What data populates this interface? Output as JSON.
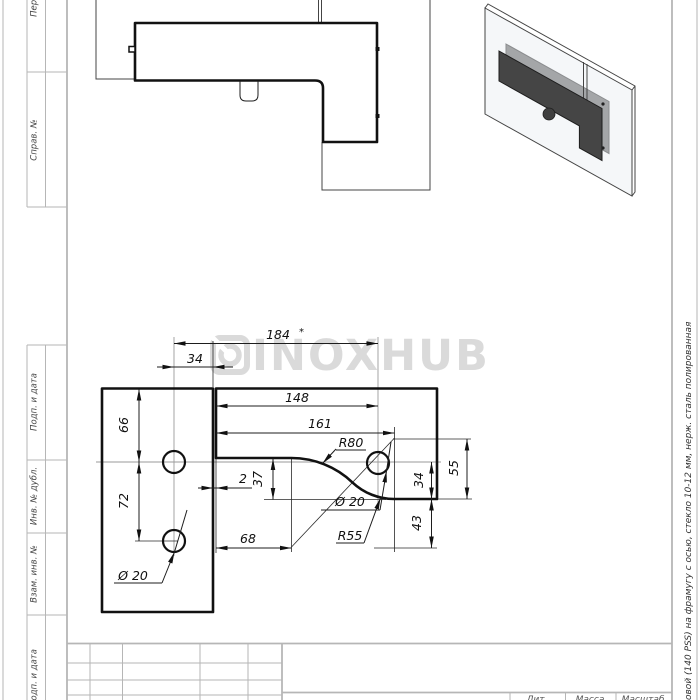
{
  "watermark": {
    "brand": "INOXHUB",
    "color": "#dadada"
  },
  "left_margin": {
    "boxes": [
      {
        "label": "Перв. примен."
      },
      {
        "label": "Справ. №"
      },
      {
        "label": "Подп. и дата"
      },
      {
        "label": "Инв. № дубл."
      },
      {
        "label": "Взам. инв. №"
      },
      {
        "label": "Подп. и дата"
      }
    ]
  },
  "right_margin": {
    "description": "овой (140 PSS)  на фрамугу с осью, стекло 10-12 мм, нерж. сталь полированная"
  },
  "title_block": {
    "lit": "Лит.",
    "mass": "Масса",
    "scale_label": "Масштаб"
  },
  "dimensions": {
    "overall_width": "184",
    "overall_star": "*",
    "hole_to_edge": "34",
    "gap": "2",
    "edge_to_hole": "148",
    "edge_to_r55_center": "161",
    "top_to_hole": "66",
    "hole_spacing": "72",
    "curve_drop": "37",
    "edge_to_r80_center": "68",
    "r55_center_height": "55",
    "hole_to_bottom": "34",
    "r80_center_below": "43",
    "radius_big": "R80",
    "radius_small": "R55",
    "hole_dia_left": "Ø 20",
    "hole_dia_right": "Ø 20"
  },
  "colors": {
    "drawing_line": "#111111",
    "frame_line": "#b6b6b6",
    "fitting_front": "#454545",
    "fitting_back": "#5d5d5d",
    "watermark": "#dadada"
  }
}
